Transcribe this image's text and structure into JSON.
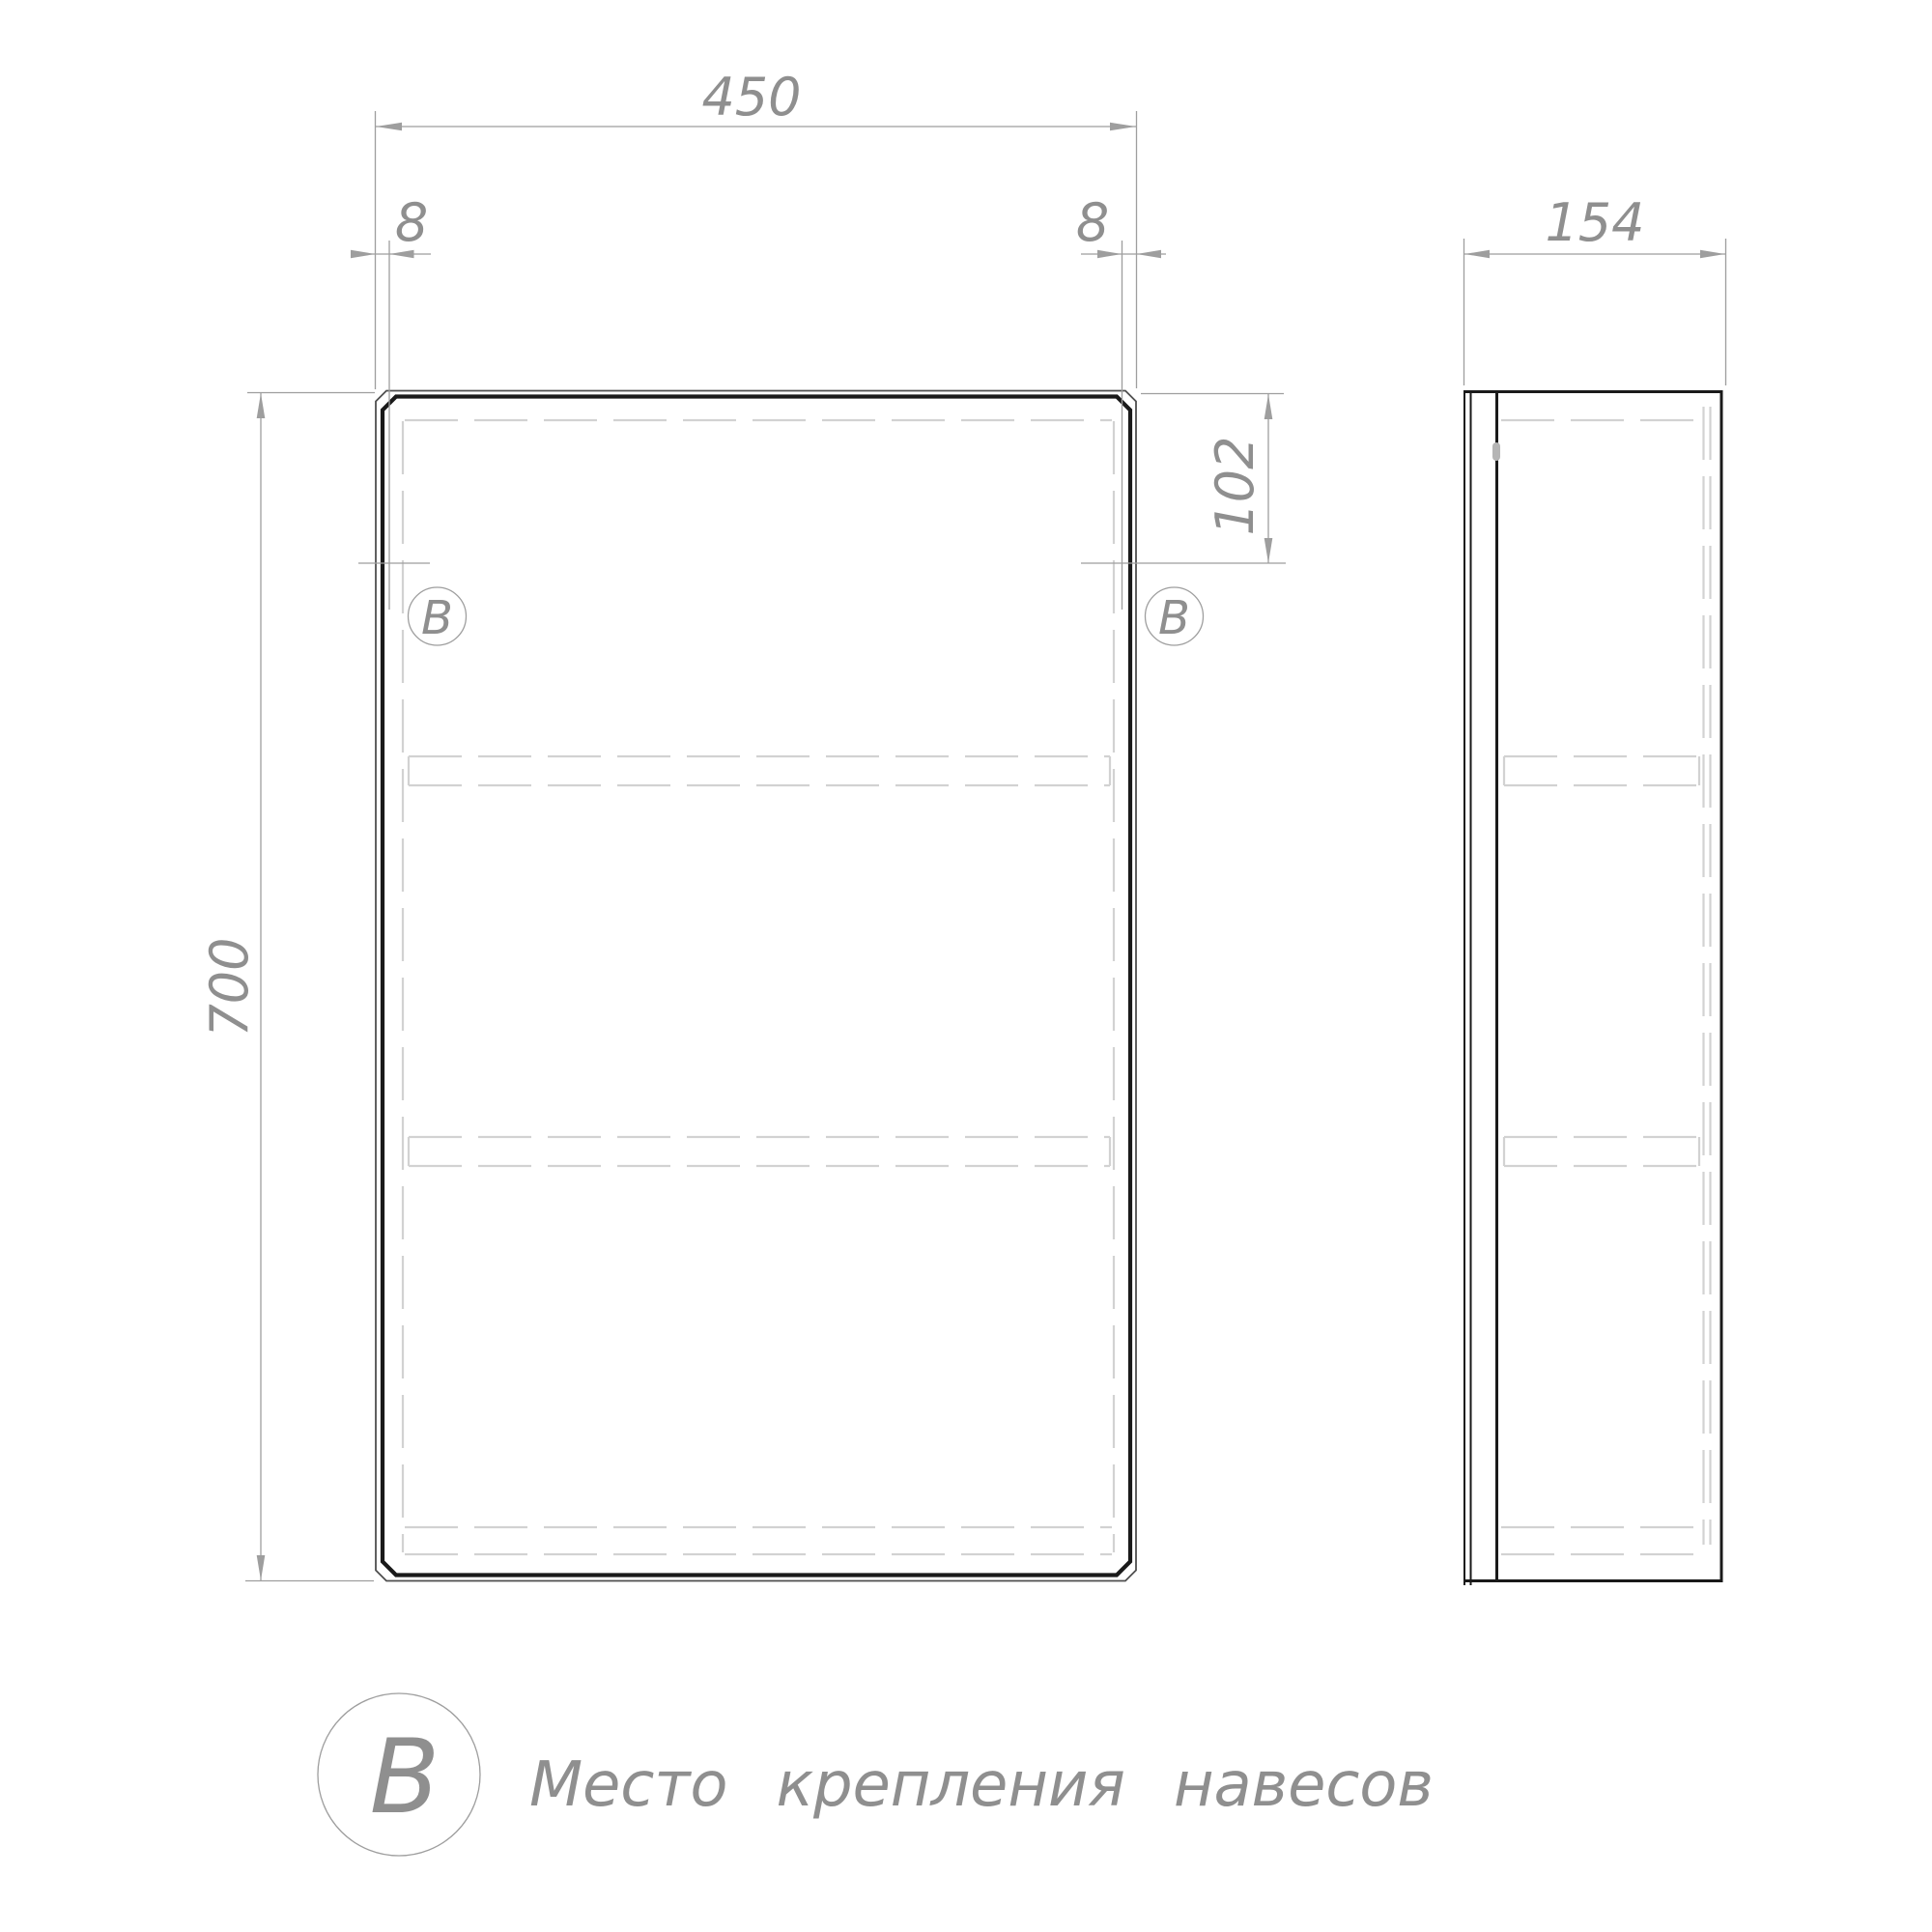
{
  "dimensions": {
    "width": "450",
    "height": "700",
    "depth": "154",
    "side_offset_left": "8",
    "side_offset_right": "8",
    "mount_from_top": "102"
  },
  "markers": {
    "front_left": "В",
    "front_right": "В"
  },
  "legend": {
    "symbol": "В",
    "caption": "Место крепления навесов"
  },
  "colors": {
    "bg": "#ffffff",
    "outline_thick": "#1a1a1a",
    "outline_thin": "#4f4f4f",
    "dim": "#9e9e9e",
    "hidden": "#d2d2d2",
    "text": "#8f8f8f",
    "hinge": "#b5b5b5"
  }
}
